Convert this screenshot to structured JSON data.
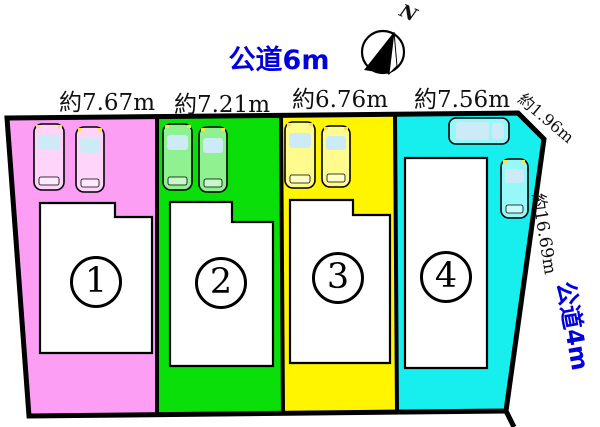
{
  "diagram": {
    "road_top_label": "公道6m",
    "road_right_label": "公道4m",
    "north_label": "N",
    "chamfer_length_label": "約1.96m",
    "right_depth_label": "約16.69m"
  },
  "lots": [
    {
      "number": "1",
      "width_label": "約7.67m",
      "color": "#FC9FF4"
    },
    {
      "number": "2",
      "width_label": "約7.21m",
      "color": "#0ADF0A"
    },
    {
      "number": "3",
      "width_label": "約6.76m",
      "color": "#FFF500"
    },
    {
      "number": "4",
      "width_label": "約7.56m",
      "color": "#17EFEF"
    }
  ],
  "colors": {
    "road_label_blue": "#0000DD",
    "outline_black": "#000000",
    "house_fill": "#FFFFFF",
    "car_window": "#CDEAF7",
    "headlight": "#FFE24A"
  },
  "icons": {
    "compass": "compass-rose-north-arrow",
    "car": "car-top-view"
  }
}
